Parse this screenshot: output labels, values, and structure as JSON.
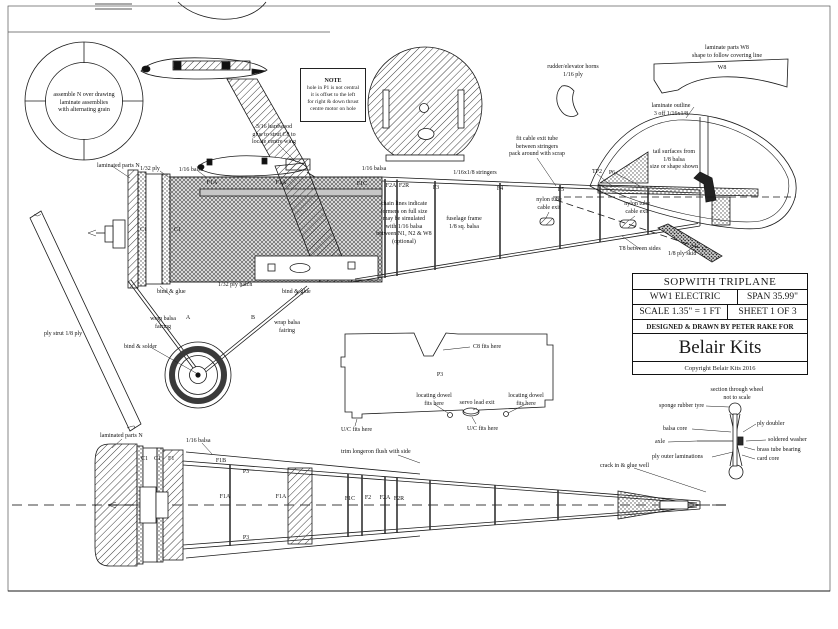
{
  "colors": {
    "ink": "#1a1a1a",
    "paper": "#ffffff",
    "hatch": "#444444"
  },
  "title_block": {
    "title": "SOPWITH TRIPLANE",
    "type": "WW1 ELECTRIC",
    "span": "SPAN 35.99\"",
    "scale": "SCALE 1.35\" = 1 FT",
    "sheet": "SHEET 1 OF 3",
    "designed_by": "DESIGNED & DRAWN BY PETER RAKE FOR",
    "brand": "Belair Kits",
    "copyright": "Copyright Belair Kits 2016"
  },
  "note_box": {
    "title": "NOTE",
    "body": "hole in P1 is not central\nit is offset to the left\nfor right & down thrust\ncentre motor on hole"
  },
  "annotations": [
    {
      "name": "ring-assembly-note",
      "text": "assemble N over drawing\nlaminate assemblies\nwith alternating grain",
      "x": 84,
      "y": 92,
      "align": "center"
    },
    {
      "name": "laminated-parts-n-side",
      "text": "laminated parts N",
      "x": 97,
      "y": 163
    },
    {
      "name": "ply-strut-label",
      "text": "ply strut 1/8 ply",
      "x": 44,
      "y": 331
    },
    {
      "name": "ply-132-label",
      "text": "1/32 ply",
      "x": 150,
      "y": 166,
      "align": "center"
    },
    {
      "name": "balsa-116-side-a",
      "text": "1/16 balsa",
      "x": 191,
      "y": 167,
      "align": "center"
    },
    {
      "name": "hardwood-note",
      "text": "3/16 hardwood\nglue to strut C8 to\nlocate centre wing",
      "x": 274,
      "y": 124,
      "align": "center"
    },
    {
      "name": "c1-side-a",
      "text": "C1",
      "x": 140,
      "y": 227
    },
    {
      "name": "c1-side-b",
      "text": "C1",
      "x": 174,
      "y": 227
    },
    {
      "name": "f1a-side-a",
      "text": "F1A",
      "x": 212,
      "y": 180,
      "align": "center"
    },
    {
      "name": "f1a-side-b",
      "text": "F1A",
      "x": 281,
      "y": 180,
      "align": "center"
    },
    {
      "name": "f1c-side",
      "text": "F1C",
      "x": 362,
      "y": 181,
      "align": "center"
    },
    {
      "name": "f2a-side",
      "text": "F2A",
      "x": 391,
      "y": 183,
      "align": "center"
    },
    {
      "name": "f2r-side",
      "text": "F2R",
      "x": 404,
      "y": 183,
      "align": "center"
    },
    {
      "name": "f3-side",
      "text": "F3",
      "x": 436,
      "y": 185,
      "align": "center"
    },
    {
      "name": "f4-side",
      "text": "F4",
      "x": 500,
      "y": 186,
      "align": "center"
    },
    {
      "name": "f5-side",
      "text": "F5",
      "x": 561,
      "y": 187,
      "align": "center"
    },
    {
      "name": "stringers-label",
      "text": "1/16x1/8 stringers",
      "x": 475,
      "y": 170,
      "align": "center"
    },
    {
      "name": "balsa-116-side-b",
      "text": "1/16 balsa",
      "x": 374,
      "y": 166,
      "align": "center"
    },
    {
      "name": "fit-cable-note",
      "text": "fit cable exit tube\nbetween stringers\npack around with scrap",
      "x": 537,
      "y": 136,
      "align": "center"
    },
    {
      "name": "tp2-side",
      "text": "TP2",
      "x": 597,
      "y": 169,
      "align": "center"
    },
    {
      "name": "p6-side",
      "text": "P6",
      "x": 612,
      "y": 170,
      "align": "center"
    },
    {
      "name": "tail-surfaces-note",
      "text": "tail surfaces from\n1/8 balsa\nsize or shape shown",
      "x": 674,
      "y": 149,
      "align": "center"
    },
    {
      "name": "laminate-outline-note",
      "text": "laminate outline\n3 off 1/16x1/8",
      "x": 671,
      "y": 103,
      "align": "center"
    },
    {
      "name": "rudder-horns-note",
      "text": "rudder/elevator horns\n1/16 ply",
      "x": 573,
      "y": 64,
      "align": "center"
    },
    {
      "name": "w8-note",
      "text": "laminate parts W8\nshape to follow covering line",
      "x": 727,
      "y": 45,
      "align": "center"
    },
    {
      "name": "w8-label",
      "text": "W8",
      "x": 722,
      "y": 65,
      "align": "center"
    },
    {
      "name": "chain-lines-note",
      "text": "chain lines indicate\nformers on full size\nmay be simulated\nwith 1/16 balsa\nbetween N1, N2 & W8\n(optional)",
      "x": 404,
      "y": 201,
      "align": "center"
    },
    {
      "name": "fuselage-frame-note",
      "text": "fuselage frame\n1/8 sq. balsa",
      "x": 464,
      "y": 216,
      "align": "center"
    },
    {
      "name": "nylon-tube-exit-a",
      "text": "nylon tube\ncable exit",
      "x": 549,
      "y": 197,
      "align": "center"
    },
    {
      "name": "nylon-tube-exit-b",
      "text": "nylon tube\ncable exit",
      "x": 637,
      "y": 201,
      "align": "center"
    },
    {
      "name": "t8-note",
      "text": "T8 between sides",
      "x": 619,
      "y": 246
    },
    {
      "name": "skid-note",
      "text": "1/8 ply skid",
      "x": 668,
      "y": 251
    },
    {
      "name": "bind-glue-a",
      "text": "bind & glue",
      "x": 157,
      "y": 289
    },
    {
      "name": "ply-hatch-note",
      "text": "1/32 ply hatch",
      "x": 218,
      "y": 282
    },
    {
      "name": "bind-glue-b",
      "text": "bind & glue",
      "x": 282,
      "y": 289
    },
    {
      "name": "wrap-balsa-a",
      "text": "wrap balsa\nfairing",
      "x": 163,
      "y": 316,
      "align": "center"
    },
    {
      "name": "strut-a-label",
      "text": "A",
      "x": 188,
      "y": 315,
      "align": "center"
    },
    {
      "name": "strut-b-label",
      "text": "B",
      "x": 253,
      "y": 315,
      "align": "center"
    },
    {
      "name": "wrap-balsa-b",
      "text": "wrap balsa\nfairing",
      "x": 287,
      "y": 320,
      "align": "center"
    },
    {
      "name": "bind-solder-note",
      "text": "bind & solder",
      "x": 124,
      "y": 344
    },
    {
      "name": "c8-fits-note",
      "text": "C8 fits here",
      "x": 473,
      "y": 344
    },
    {
      "name": "p3-template-label",
      "text": "P3",
      "x": 440,
      "y": 372,
      "align": "center"
    },
    {
      "name": "locating-dowel-a",
      "text": "locating dowel\nfits here",
      "x": 434,
      "y": 393,
      "align": "center"
    },
    {
      "name": "locating-dowel-b",
      "text": "locating dowel\nfits here",
      "x": 526,
      "y": 393,
      "align": "center"
    },
    {
      "name": "servo-lead-note",
      "text": "servo lead exit",
      "x": 477,
      "y": 400,
      "align": "center"
    },
    {
      "name": "uc-fits-a",
      "text": "U/C fits here",
      "x": 341,
      "y": 427
    },
    {
      "name": "uc-fits-b",
      "text": "U/C fits here",
      "x": 467,
      "y": 426
    },
    {
      "name": "trim-longeron-note",
      "text": "trim longeron flush with side",
      "x": 341,
      "y": 449
    },
    {
      "name": "laminated-parts-n-plan",
      "text": "laminated parts N",
      "x": 100,
      "y": 433
    },
    {
      "name": "balsa-116-plan",
      "text": "1/16 balsa",
      "x": 186,
      "y": 438
    },
    {
      "name": "c1-plan-a",
      "text": "C1",
      "x": 141,
      "y": 456
    },
    {
      "name": "c1-plan-b",
      "text": "C1",
      "x": 154,
      "y": 456
    },
    {
      "name": "f1-plan",
      "text": "F1",
      "x": 168,
      "y": 456
    },
    {
      "name": "f1b-plan",
      "text": "F1B",
      "x": 221,
      "y": 458,
      "align": "center"
    },
    {
      "name": "p3-plan-top",
      "text": "P3",
      "x": 246,
      "y": 469,
      "align": "center"
    },
    {
      "name": "f1a-plan-a",
      "text": "F1A",
      "x": 225,
      "y": 494,
      "align": "center"
    },
    {
      "name": "f1a-plan-b",
      "text": "F1A",
      "x": 281,
      "y": 494,
      "align": "center"
    },
    {
      "name": "p3-plan-bottom",
      "text": "P3",
      "x": 246,
      "y": 535,
      "align": "center"
    },
    {
      "name": "f1c-plan",
      "text": "F1C",
      "x": 350,
      "y": 496,
      "align": "center"
    },
    {
      "name": "f2-plan",
      "text": "F2",
      "x": 368,
      "y": 495,
      "align": "center"
    },
    {
      "name": "f2a-plan",
      "text": "F2A",
      "x": 385,
      "y": 495,
      "align": "center"
    },
    {
      "name": "f2r-plan",
      "text": "F2R",
      "x": 399,
      "y": 496,
      "align": "center"
    },
    {
      "name": "crack-glue-note",
      "text": "crack in & glue well",
      "x": 600,
      "y": 463
    },
    {
      "name": "wheel-section-note",
      "text": "section through wheel\nnot to scale",
      "x": 737,
      "y": 387,
      "align": "center"
    },
    {
      "name": "sponge-tyre-label",
      "text": "sponge rubber tyre",
      "x": 659,
      "y": 403
    },
    {
      "name": "balsa-core-label",
      "text": "balsa core",
      "x": 663,
      "y": 426
    },
    {
      "name": "axle-label",
      "text": "axle",
      "x": 655,
      "y": 439
    },
    {
      "name": "ply-outer-label",
      "text": "ply outer laminations",
      "x": 652,
      "y": 454
    },
    {
      "name": "ply-doubler-label",
      "text": "ply doubler",
      "x": 757,
      "y": 421
    },
    {
      "name": "soldered-washer-label",
      "text": "soldered washer",
      "x": 768,
      "y": 437
    },
    {
      "name": "brass-tube-label",
      "text": "brass tube bearing",
      "x": 757,
      "y": 447
    },
    {
      "name": "card-core-label",
      "text": "card core",
      "x": 757,
      "y": 456
    }
  ]
}
